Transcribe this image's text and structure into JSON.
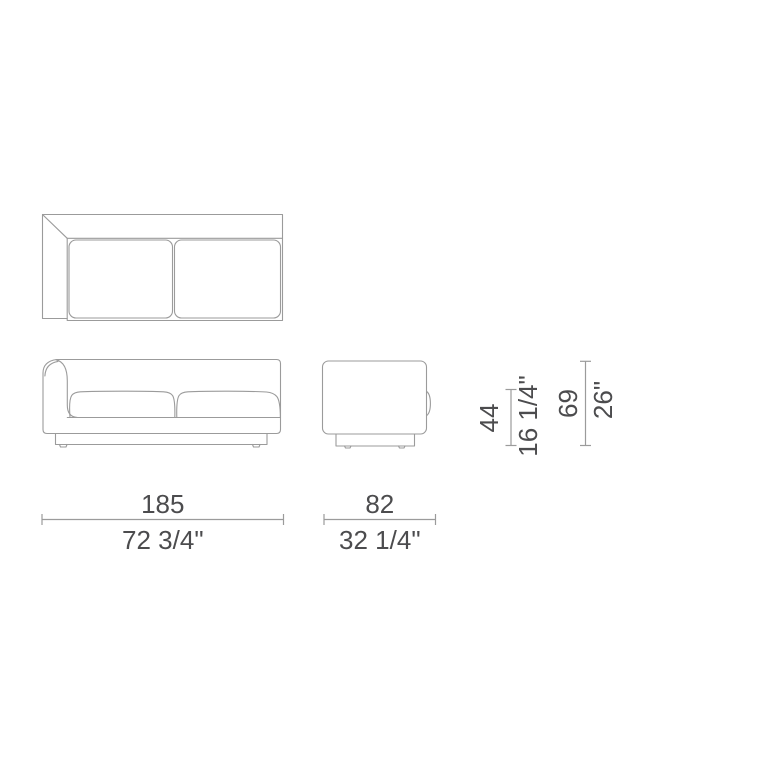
{
  "diagram": {
    "type": "furniture-technical-drawing",
    "subject": "one-arm two-seat sofa",
    "views": [
      "top",
      "front",
      "side"
    ]
  },
  "dimensions": {
    "width": {
      "cm": "185",
      "inches": "72 3/4\""
    },
    "depth": {
      "cm": "82",
      "inches": "32 1/4\""
    },
    "seat_height": {
      "cm": "44",
      "inches": "16 1/4\""
    },
    "height": {
      "cm": "69",
      "inches": "26\""
    }
  },
  "colors": {
    "line": "#9b9b9b",
    "text": "#4c4c4e",
    "background": "#ffffff"
  }
}
